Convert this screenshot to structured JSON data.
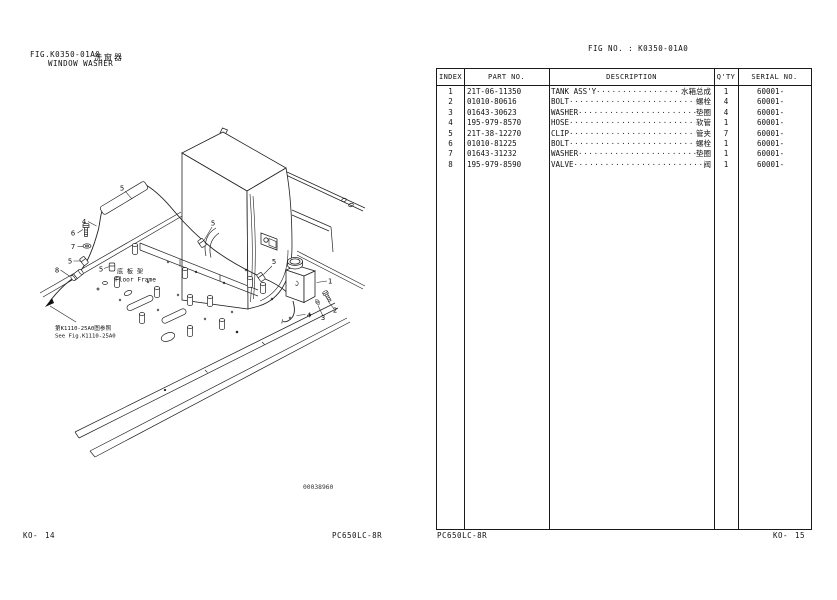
{
  "page": {
    "left_header": {
      "fig_label": "FIG.K0350-01A0",
      "title_en": "WINDOW WASHER",
      "title_zh": "洗窗器"
    },
    "right_header": {
      "fig_no": "FIG NO. : K0350-01A0"
    },
    "footer": {
      "left_code": "KO-",
      "left_num": "14",
      "left_model": "PC650LC-8R",
      "right_model": "PC650LC-8R",
      "right_code": "KO-",
      "right_num": "15"
    }
  },
  "diagram": {
    "drawing_number": "00038960",
    "floor_frame_label_zh": "底 板 架",
    "floor_frame_label_en": "Floor Frame",
    "see_fig_zh": "第K1110-25A0图参照",
    "see_fig_en": "See Fig.K1110-25A0",
    "callouts": [
      "5",
      "4",
      "6",
      "7",
      "5",
      "8",
      "5",
      "5",
      "5",
      "1",
      "2",
      "3",
      "4"
    ]
  },
  "table": {
    "headers": {
      "index": "INDEX",
      "part_no": "PART NO.",
      "description": "DESCRIPTION",
      "qty": "Q'TY",
      "serial_no": "SERIAL NO."
    },
    "rows": [
      {
        "index": "1",
        "part_no": "21T-06-11350",
        "desc_en": "TANK ASS'Y",
        "desc_zh": "水箱总成",
        "qty": "1",
        "serial": "60001-"
      },
      {
        "index": "2",
        "part_no": "01010-80616",
        "desc_en": "BOLT",
        "desc_zh": "螺栓",
        "qty": "4",
        "serial": "60001-"
      },
      {
        "index": "3",
        "part_no": "01643-30623",
        "desc_en": "WASHER",
        "desc_zh": "垫圈",
        "qty": "4",
        "serial": "60001-"
      },
      {
        "index": "4",
        "part_no": "195-979-8570",
        "desc_en": "HOSE",
        "desc_zh": "软管",
        "qty": "1",
        "serial": "60001-"
      },
      {
        "index": "5",
        "part_no": "21T-38-12270",
        "desc_en": "CLIP",
        "desc_zh": "管夹",
        "qty": "7",
        "serial": "60001-"
      },
      {
        "index": "6",
        "part_no": "01010-81225",
        "desc_en": "BOLT",
        "desc_zh": "螺栓",
        "qty": "1",
        "serial": "60001-"
      },
      {
        "index": "7",
        "part_no": "01643-31232",
        "desc_en": "WASHER",
        "desc_zh": "垫圈",
        "qty": "1",
        "serial": "60001-"
      },
      {
        "index": "8",
        "part_no": "195-979-8590",
        "desc_en": "VALVE",
        "desc_zh": "阀",
        "qty": "1",
        "serial": "60001-"
      }
    ]
  }
}
